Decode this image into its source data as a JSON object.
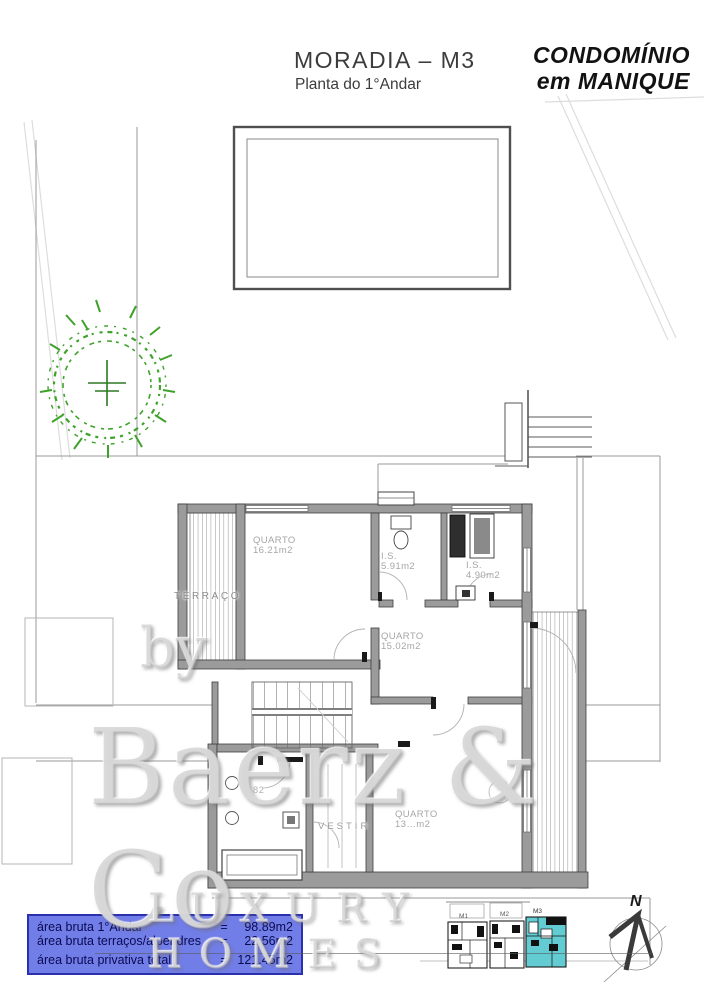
{
  "header": {
    "title": "MORADIA – M3",
    "subtitle": "Planta do 1°Andar",
    "brand": {
      "line1": "CONDOMÍNIO",
      "line2": "em MANIQUE"
    }
  },
  "plan": {
    "rooms": [
      {
        "label": "TERRAÇO",
        "area": ""
      },
      {
        "label": "QUARTO",
        "area": "16.21m2"
      },
      {
        "label": "I.S.",
        "area": "5.91m2"
      },
      {
        "label": "I.S.",
        "area": "4.90m2"
      },
      {
        "label": "QUARTO",
        "area": "15.02m2"
      },
      {
        "label": "VESTIR",
        "area": ""
      },
      {
        "label": "QUARTO",
        "area": "13…m2"
      },
      {
        "label": "",
        "area": "…82"
      }
    ],
    "wall_color": "#9b9b9b",
    "tree_color": "#3fa32b"
  },
  "legend": {
    "background": "#727ee8",
    "border_color": "#2b31ad",
    "text_color": "#0a0a52",
    "rows": [
      {
        "label": "área bruta 1°Andar",
        "eq": "=",
        "value": "98.89m2"
      },
      {
        "label": "área bruta terraços/alpendres",
        "eq": "=",
        "value": "22.56m2"
      },
      {
        "label": "área bruta privativa total",
        "eq": "=",
        "value": "121.45m2"
      }
    ]
  },
  "site_plan": {
    "highlight_color": "#63ccd2",
    "units": [
      {
        "label": "M1"
      },
      {
        "label": "M2"
      },
      {
        "label": "M3",
        "highlighted": true
      }
    ]
  },
  "compass": {
    "label": "N"
  },
  "watermark": {
    "prefix": "by",
    "name": "Baerz & Co",
    "tagline": "LUXURY HOMES"
  }
}
